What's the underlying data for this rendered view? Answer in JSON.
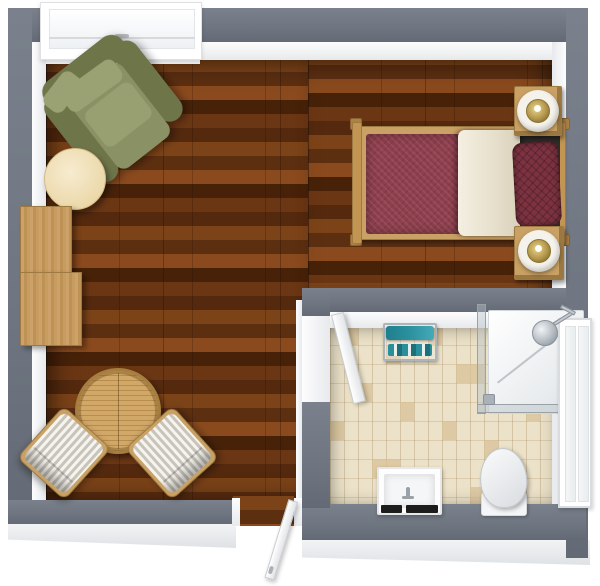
{
  "meta": {
    "title": "3D floor plan — bedroom with ensuite bathroom",
    "view": "top-down 3D render"
  },
  "palette": {
    "wall_gray": "#6e7580",
    "wood_a": "#7c4318",
    "wood_b": "#5d2f11",
    "wood_c": "#8a4a1d",
    "wood_d": "#472209",
    "tile_base": "#ece2c9",
    "tile_dark": "#d8c096",
    "teal": "#2a8f9c",
    "duvet": "#8e3e4d",
    "pillow": "#7c3240",
    "sheet_dark": "#2e2b28",
    "olive": "#8a9164",
    "olive_dark": "#6e7549",
    "olive_light": "#9aa274",
    "tan": "#c9a164",
    "cream_table": "#ecd9ab"
  },
  "rooms": [
    {
      "id": "bedroom",
      "floor": "dark walnut plank flooring"
    },
    {
      "id": "bathroom",
      "floor": "beige brick-laid tiles"
    }
  ],
  "objects": {
    "window": "Window",
    "armchair": "Olive green armchair",
    "side_table": "Round side table",
    "sideboard": "Wooden sideboard",
    "bistro_table": "Round slatted wooden table",
    "chair_left": "Striped upholstered chair",
    "chair_right": "Striped upholstered chair",
    "bed": "Single bed with maroon bedding",
    "nightstand_top": "Nightstand with lamp",
    "nightstand_bottom": "Nightstand with lamp",
    "entry_door": "Entry door (open outward)",
    "bathroom_door": "Bathroom door (open inward)",
    "towel_bench": "Bench with teal towels",
    "shower": "Corner shower with glass enclosure",
    "bathroom_window": "Bathroom window",
    "toilet": "Toilet",
    "sink": "Wall-mounted sink"
  }
}
